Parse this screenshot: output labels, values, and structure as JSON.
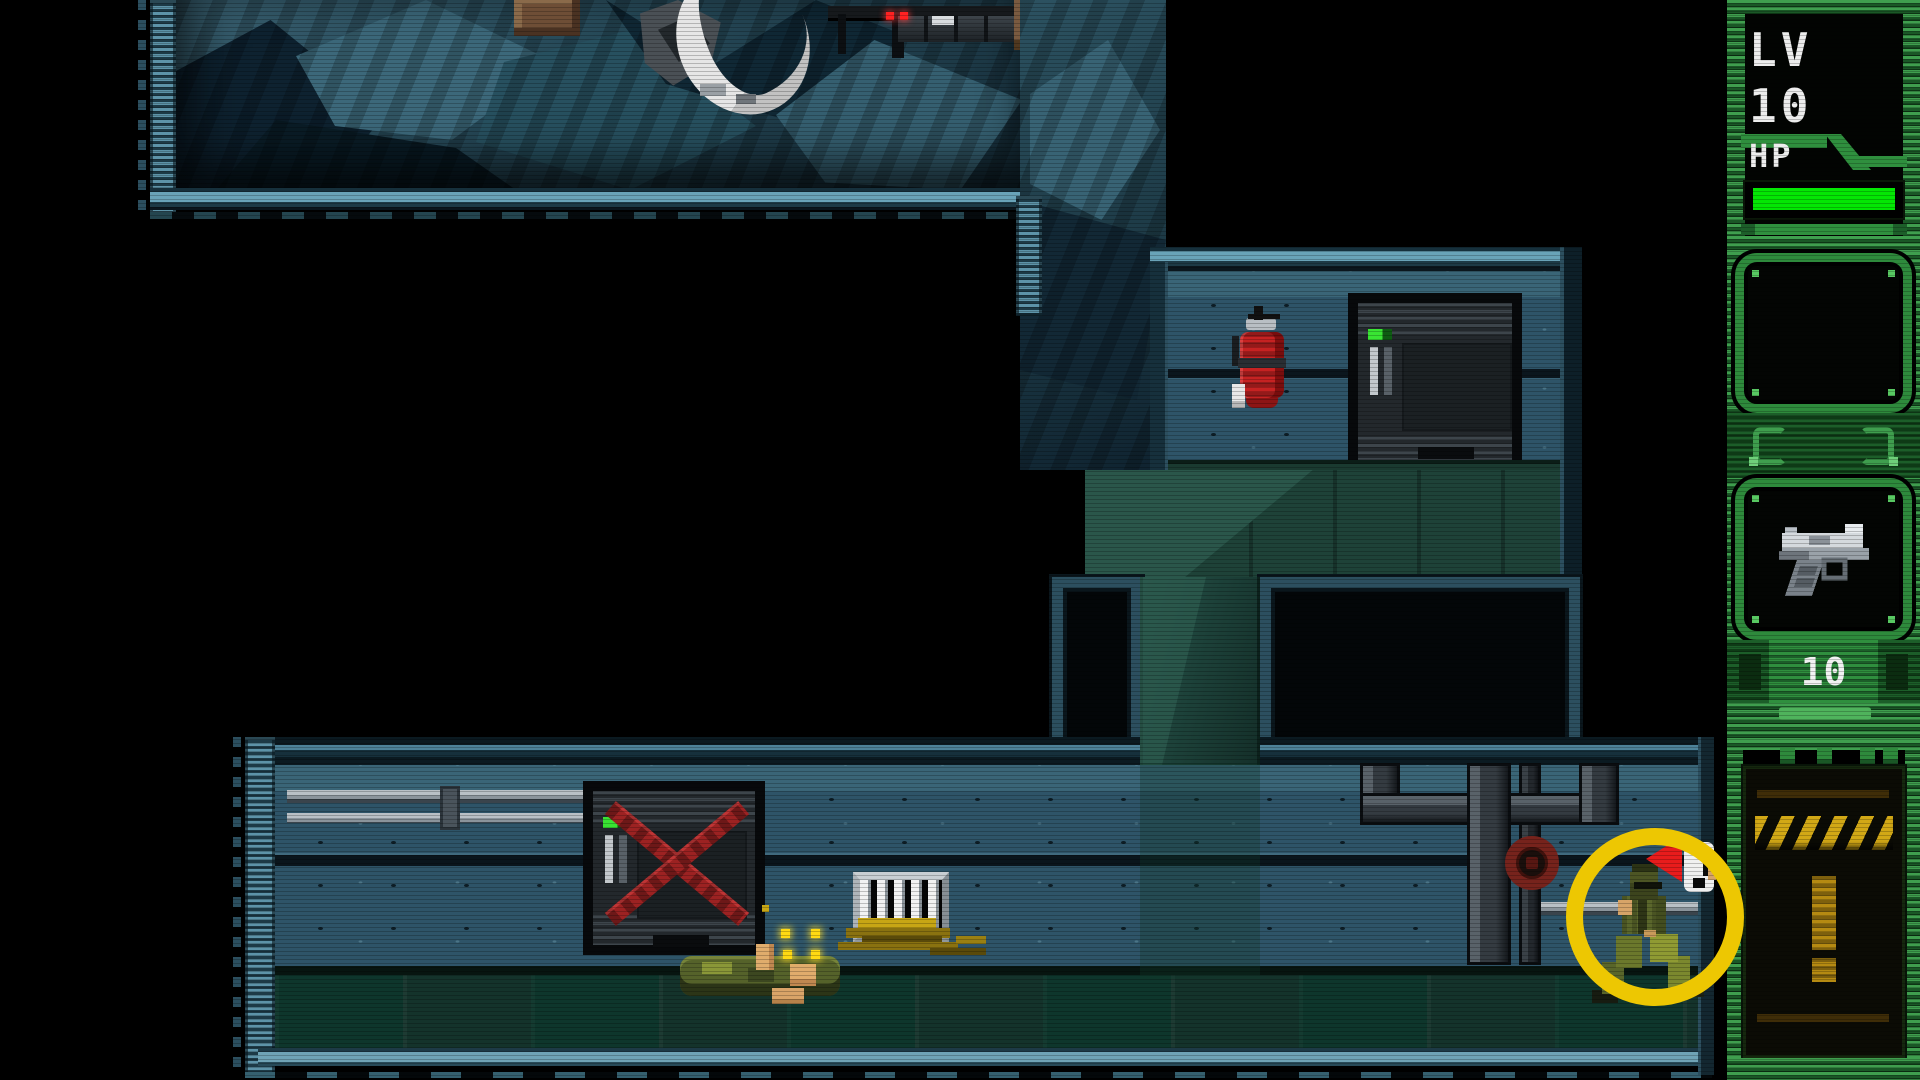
{
  "hud": {
    "level": {
      "label": "LV 10"
    },
    "health": {
      "label": "HP",
      "value_percent": 100,
      "bar_color": "#04e704"
    },
    "inventory": {
      "slot_1": {
        "state": "empty",
        "item": ""
      },
      "slot_2": {
        "state": "equipped",
        "item": "pistol",
        "icon": "pistol-icon",
        "ammo": "10"
      }
    },
    "alert_panel": {
      "symbol": "!",
      "style": "hazard-stripes",
      "stripe_color": "#d2a816",
      "symbol_color": "#b58a12"
    },
    "colors": {
      "frame_green": "#2e8a3c",
      "frame_green_light": "#3f9e4e",
      "frame_green_dark": "#1a5726",
      "hp_green": "#04e704",
      "tab_green": "#2f8f3e"
    }
  },
  "game": {
    "player": {
      "name": "soldier",
      "status": "alerted",
      "alert_symbol": "!",
      "highlight": "yellow-circle",
      "highlight_color": "#edc702",
      "alert_marker_color": "#e81c1c"
    },
    "entities": [
      {
        "name": "wrecked-machine",
        "location": "cave-room"
      },
      {
        "name": "ceiling-sensor-red-lights",
        "location": "cave-room"
      },
      {
        "name": "fire-extinguisher",
        "location": "middle-room"
      },
      {
        "name": "control-cabinet-green-led",
        "location": "middle-room"
      },
      {
        "name": "x-marked-door",
        "location": "bottom-corridor"
      },
      {
        "name": "dead-guard",
        "location": "bottom-corridor"
      },
      {
        "name": "item-sparkles",
        "location": "bottom-corridor"
      },
      {
        "name": "barred-grate-with-straw",
        "location": "bottom-corridor"
      },
      {
        "name": "pipes-with-red-valve",
        "location": "bottom-corridor"
      }
    ],
    "colors": {
      "wall_blue": "#2e5468",
      "floor_green": "#14332b",
      "rock_teal": "#274653",
      "border_teal": "#69a3b8",
      "extinguisher_red": "#c62222",
      "x_mark_red": "#9c2222",
      "sparkle_yellow": "#ffd913"
    }
  }
}
